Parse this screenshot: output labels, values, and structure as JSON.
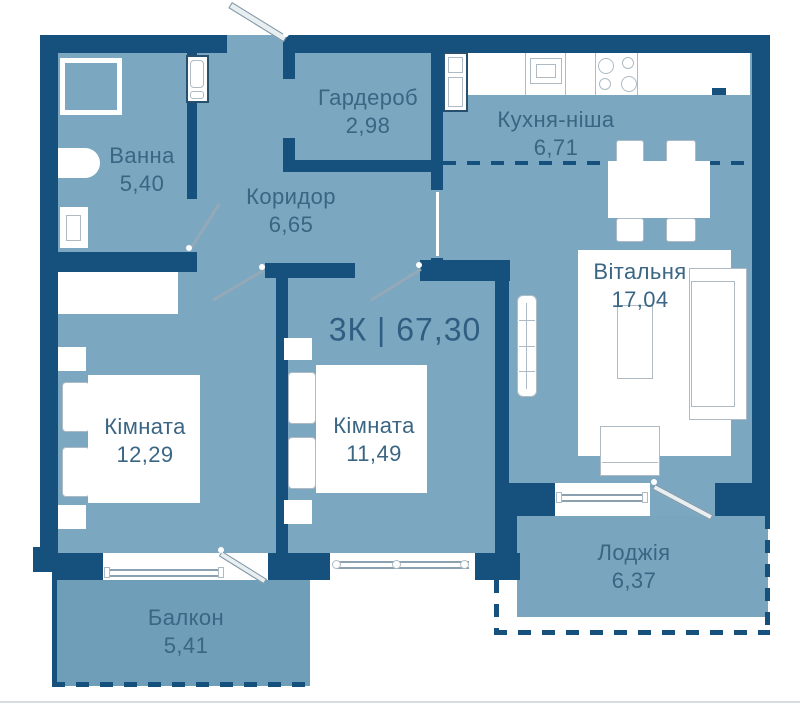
{
  "title": {
    "text": "3К | 67,30",
    "type_label": "3К",
    "total_area": "67,30"
  },
  "rooms": {
    "bathroom": {
      "name": "Ванна",
      "area": "5,40"
    },
    "wardrobe": {
      "name": "Гардероб",
      "area": "2,98"
    },
    "corridor": {
      "name": "Коридор",
      "area": "6,65"
    },
    "kitchen": {
      "name": "Кухня-ніша",
      "area": "6,71"
    },
    "living": {
      "name": "Вітальня",
      "area": "17,04"
    },
    "bedroom1": {
      "name": "Кімната",
      "area": "12,29"
    },
    "bedroom2": {
      "name": "Кімната",
      "area": "11,49"
    },
    "balcony": {
      "name": "Балкон",
      "area": "5,41"
    },
    "loggia": {
      "name": "Лоджія",
      "area": "6,37"
    }
  },
  "symbols": [
    "shower",
    "washbasin",
    "toilet",
    "washing-machine",
    "fridge",
    "kitchen-sink",
    "stove",
    "dining-table",
    "chair",
    "sofa",
    "coffee-table",
    "tv-stand",
    "radiator",
    "wardrobe-cabinet",
    "bed",
    "pillow",
    "nightstand",
    "rug",
    "window",
    "door-swing",
    "entry-door",
    "dashed-kitchen-boundary",
    "dashed-loggia-outline"
  ],
  "colors": {
    "wall": "#15517c",
    "floor": "#7ba7c1",
    "balcony-floor": "#6f9eb8",
    "loggia-floor": "#79a5bf",
    "label-text": "#3a6684",
    "title-text": "#2f5e82",
    "furniture-outline": "#aebbc4",
    "glazing": "#8ca1af",
    "door-line": "#93a9b8",
    "rod-fill": "#e9eef1",
    "rod-border": "#7a93a4",
    "divider": "#d9dcdf"
  }
}
